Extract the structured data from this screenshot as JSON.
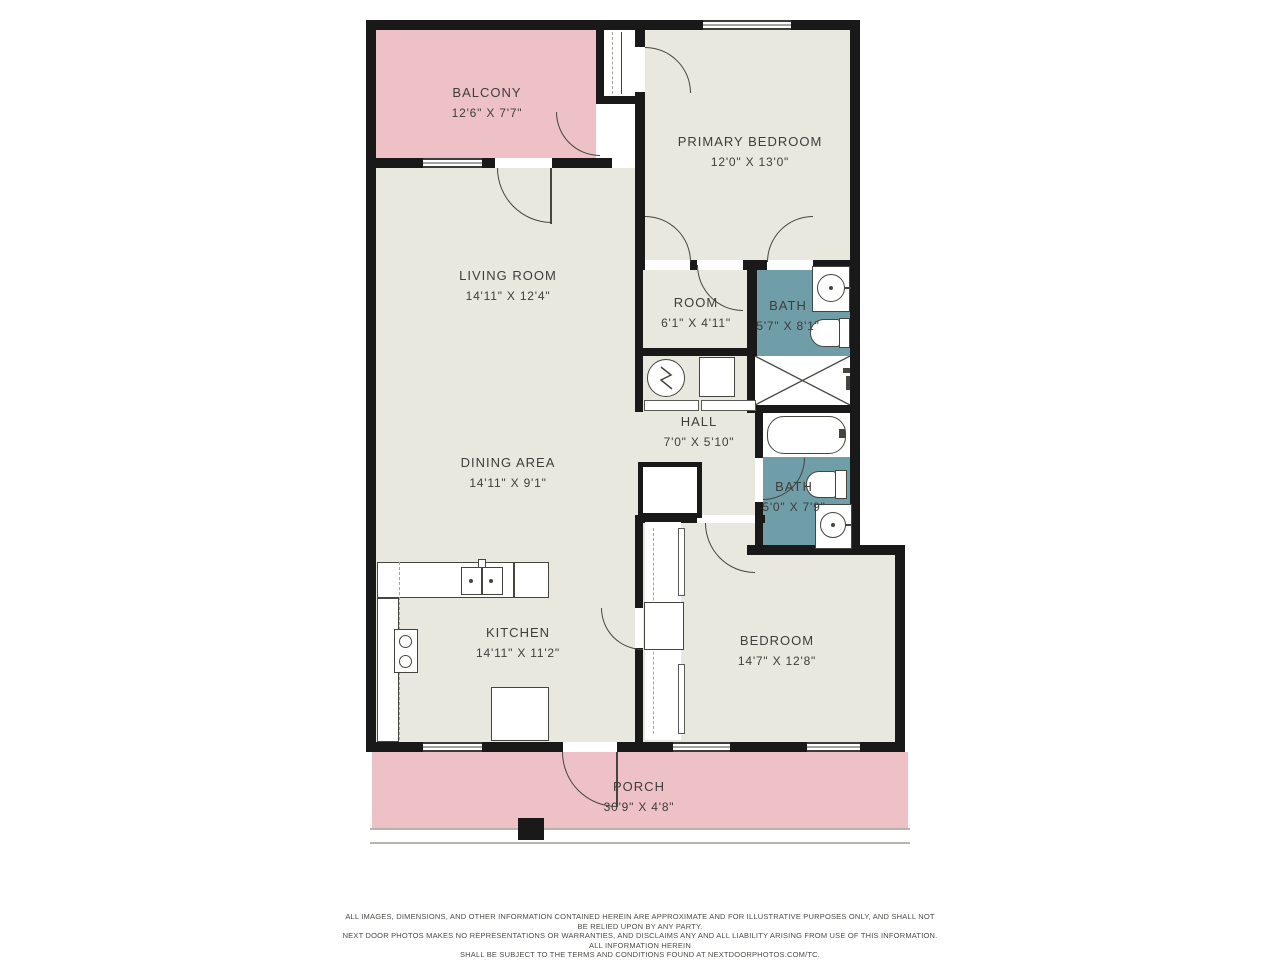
{
  "colors": {
    "background": "#ffffff",
    "wall": "#191919",
    "room_fill": "#e9e8df",
    "outdoor_pink": "#edc1c6",
    "bath_teal": "#6f9da8",
    "label_text": "#3e3e3a"
  },
  "rooms": [
    {
      "id": "balcony",
      "name": "BALCONY",
      "dims": "12'6\" X 7'7\""
    },
    {
      "id": "primary_bedroom",
      "name": "PRIMARY BEDROOM",
      "dims": "12'0\" X 13'0\""
    },
    {
      "id": "living_room",
      "name": "LIVING ROOM",
      "dims": "14'11\" X 12'4\""
    },
    {
      "id": "room",
      "name": "ROOM",
      "dims": "6'1\" X 4'11\""
    },
    {
      "id": "bath_1",
      "name": "BATH",
      "dims": "5'7\" X 8'1\""
    },
    {
      "id": "hall",
      "name": "HALL",
      "dims": "7'0\" X 5'10\""
    },
    {
      "id": "dining_area",
      "name": "DINING AREA",
      "dims": "14'11\" X 9'1\""
    },
    {
      "id": "bath_2",
      "name": "BATH",
      "dims": "5'0\" X 7'9\""
    },
    {
      "id": "kitchen",
      "name": "KITCHEN",
      "dims": "14'11\" X 11'2\""
    },
    {
      "id": "bedroom",
      "name": "BEDROOM",
      "dims": "14'7\" X 12'8\""
    },
    {
      "id": "porch",
      "name": "PORCH",
      "dims": "30'9\" X 4'8\""
    }
  ],
  "disclaimer": {
    "line1": "ALL IMAGES, DIMENSIONS, AND OTHER INFORMATION CONTAINED HEREIN ARE APPROXIMATE AND FOR ILLUSTRATIVE PURPOSES ONLY, AND SHALL NOT BE RELIED UPON BY ANY PARTY.",
    "line2": "NEXT DOOR PHOTOS MAKES NO REPRESENTATIONS OR WARRANTIES, AND DISCLAIMS ANY AND ALL LIABILITY ARISING FROM USE OF THIS INFORMATION. ALL INFORMATION HEREIN",
    "line3": "SHALL BE SUBJECT TO THE TERMS AND CONDITIONS FOUND AT NEXTDOORPHOTOS.COM/TC."
  }
}
